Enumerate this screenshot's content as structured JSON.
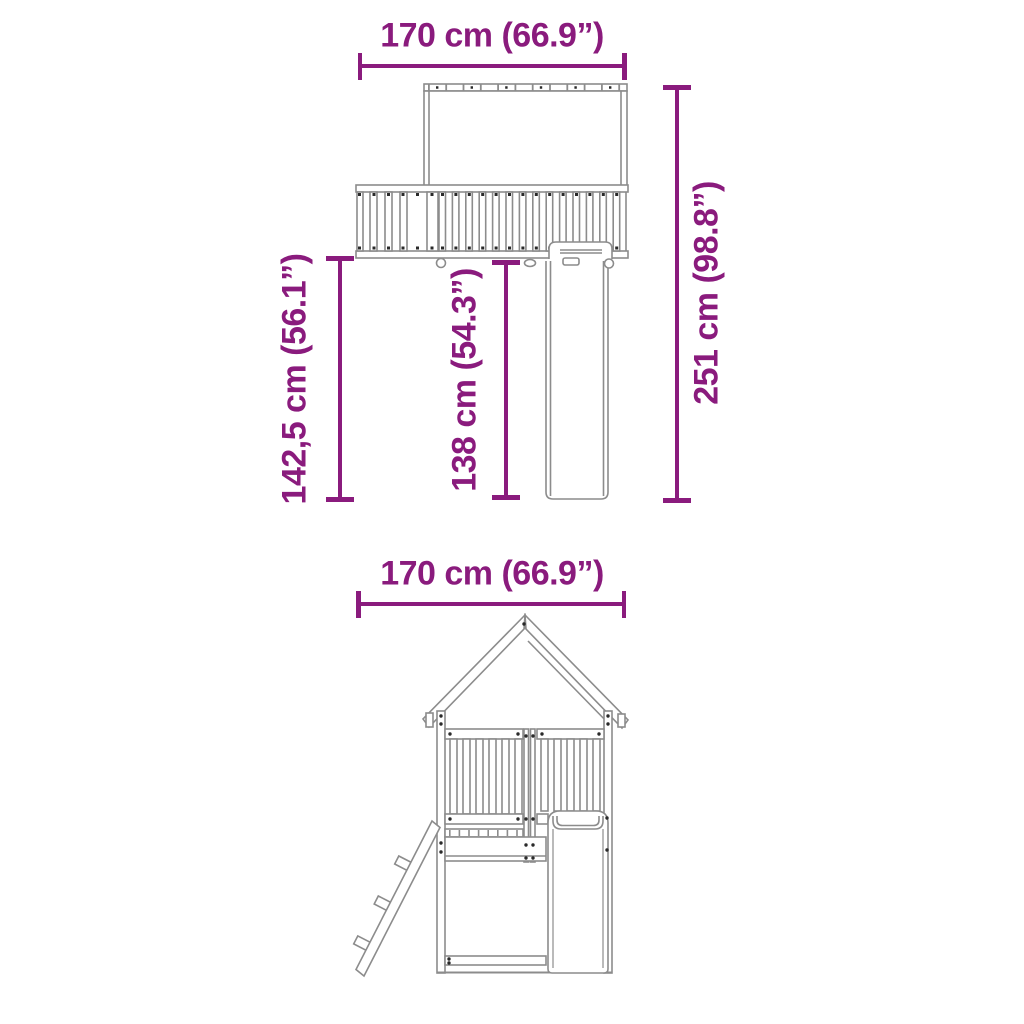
{
  "colors": {
    "dimension_accent": "#8A1B7D",
    "drawing_line": "#8C8C8C"
  },
  "side_view": {
    "width_label": "170 cm (66.9”)",
    "total_height_label": "251 cm (98.8”)",
    "platform_height_label": "142,5 cm (56.1”)",
    "slide_height_label": "138 cm (54.3”)"
  },
  "front_view": {
    "width_label": "170 cm (66.9”)"
  }
}
